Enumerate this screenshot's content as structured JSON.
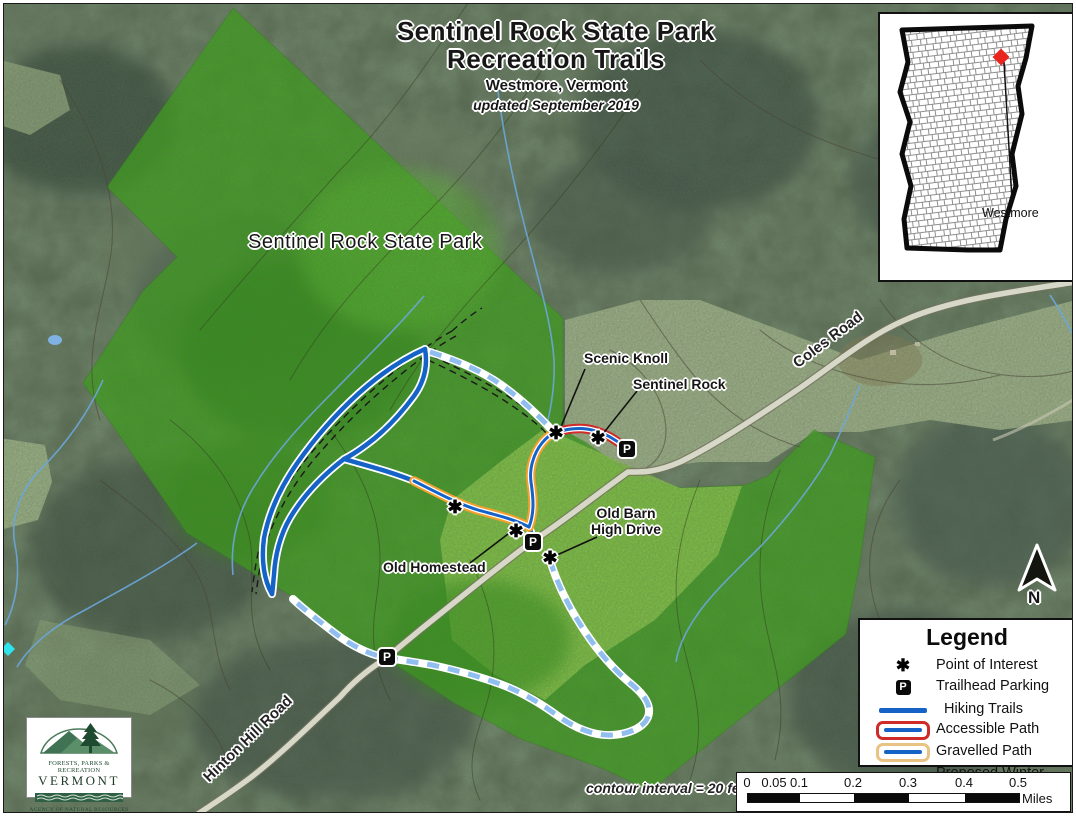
{
  "title": {
    "line1": "Sentinel Rock State Park",
    "line2": "Recreation Trails",
    "location": "Westmore, Vermont",
    "updated": "updated September 2019"
  },
  "park_label": "Sentinel Rock State Park",
  "roads": {
    "coles": "Coles Road",
    "hinton": "Hinton Hill Road"
  },
  "poi": {
    "scenic_knoll": "Scenic Knoll",
    "sentinel_rock": "Sentinel Rock",
    "old_barn_line1": "Old Barn",
    "old_barn_line2": "High Drive",
    "old_homestead": "Old Homestead"
  },
  "notes": {
    "contour": "contour interval = 20 feet"
  },
  "inset": {
    "town": "Westmore"
  },
  "north": {
    "label": "N"
  },
  "markers": {
    "poi_glyph": "✱",
    "parking_glyph": "P"
  },
  "legend": {
    "title": "Legend",
    "items": [
      {
        "symbol": "poi",
        "label": "Point of Interest"
      },
      {
        "symbol": "parking",
        "label": "Trailhead Parking"
      },
      {
        "symbol": "hiking",
        "label": "Hiking Trails"
      },
      {
        "symbol": "accessible",
        "label": "Accessible Path"
      },
      {
        "symbol": "gravelled",
        "label": "Gravelled Path"
      },
      {
        "symbol": "winter",
        "label": "Proposed Winter Trails"
      }
    ]
  },
  "scalebar": {
    "ticks": [
      "0",
      "0.05",
      "0.1",
      "0.2",
      "0.3",
      "0.4",
      "0.5"
    ],
    "unit": "Miles"
  },
  "logo": {
    "line1": "FORESTS, PARKS & RECREATION",
    "line2": "VERMONT",
    "line3": "AGENCY OF NATURAL RESOURCES"
  },
  "colors": {
    "park_green": "#3BA318",
    "meadow_green": "#8CC84B",
    "hiking_blue": "#1663C8",
    "accessible_red": "#CE2B29",
    "gravel_orange": "#F2A02E",
    "winter_blue": "#8FBEEF",
    "town_marker_red": "#E8261F"
  }
}
